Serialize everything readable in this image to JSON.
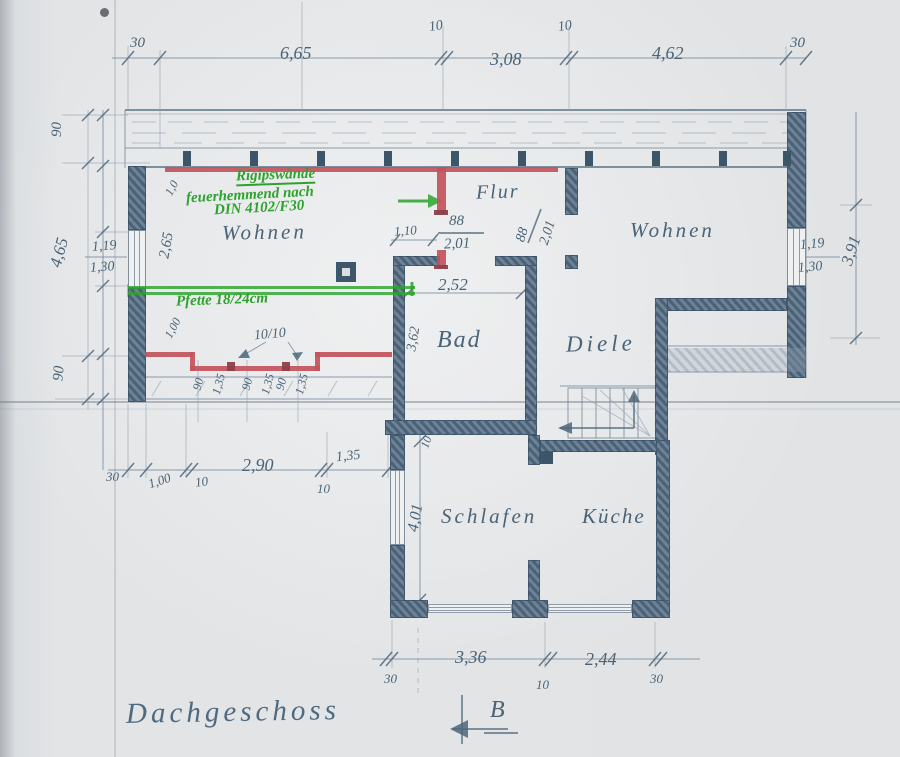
{
  "title": "Dachgeschoss",
  "section_marker": "B",
  "colors": {
    "pencil": "#4a6376",
    "red": "#c2525b",
    "green": "#2da32d",
    "paper": "#e1e3e5"
  },
  "rooms": {
    "wohnen_left": "Wohnen",
    "flur": "Flur",
    "wohnen_right": "Wohnen",
    "bad": "Bad",
    "diele": "Diele",
    "schlafen": "Schlafen",
    "kueche": "Küche"
  },
  "annotations": {
    "rigips_line1": "Rigipswände",
    "rigips_line2": "feuerhemmend nach",
    "rigips_line3": "DIN 4102/F30",
    "pfette": "Pfette 18/24cm",
    "posts_size": "10/10"
  },
  "dims": {
    "top": [
      "30",
      "6,65",
      "10",
      "3,08",
      "10",
      "4,62",
      "30"
    ],
    "left": {
      "band": "90",
      "height": "4,65",
      "win_top": "1,19",
      "win_bottom": "1,30",
      "wall": "2,65",
      "diag_top": "1,0",
      "band_bottom": "90",
      "diag_bottom": "1,00"
    },
    "right": {
      "win_top": "1,19",
      "win_bottom": "1,30",
      "height": "3,91"
    },
    "doors": {
      "flur_width": "1,10",
      "door1_w": "88",
      "door1_h": "2,01",
      "door2_w": "88",
      "door2_h": "2,01"
    },
    "bad": {
      "width": "2,52",
      "depth": "3,62"
    },
    "posts": [
      "90",
      "1,35",
      "90",
      "1,35",
      "90",
      "1,35"
    ],
    "row_left": [
      "30",
      "1,00",
      "10",
      "2,90",
      "10",
      "1,35"
    ],
    "lower": {
      "wall": "10",
      "schlafen_depth": "4,01"
    },
    "bottom": [
      "30",
      "3,36",
      "10",
      "2,44",
      "30"
    ]
  }
}
